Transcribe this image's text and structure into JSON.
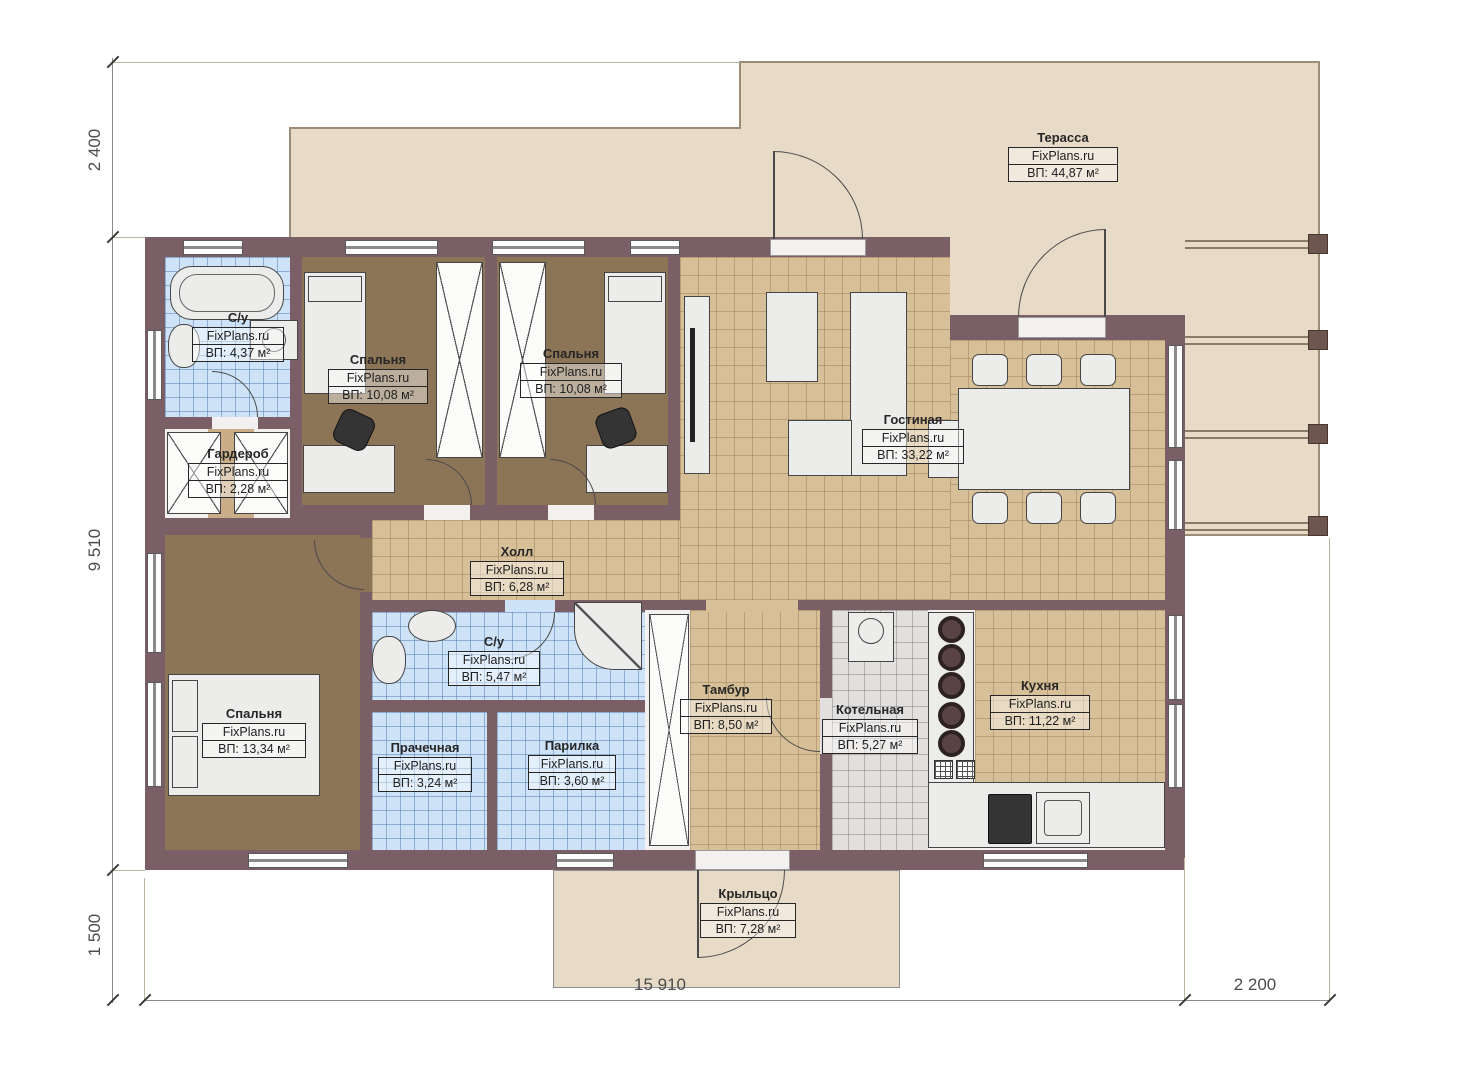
{
  "title": "План одноэтажного дома",
  "brand": "FixPlans.ru",
  "colors": {
    "wall": "#7a5f66",
    "terrace": "#e7dac6",
    "tileBlue": "#cfe3f8",
    "tileTan": "#d7bf98",
    "tileGray": "#e2e0df",
    "wood": "#8c7457"
  },
  "rooms": [
    {
      "id": "terrace",
      "name": "Терасса",
      "brand": "FixPlans.ru",
      "area": "ВП: 44,87 м²"
    },
    {
      "id": "bathroom-1",
      "name": "С/у",
      "brand": "FixPlans.ru",
      "area": "ВП: 4,37 м²"
    },
    {
      "id": "bedroom-1",
      "name": "Спальня",
      "brand": "FixPlans.ru",
      "area": "ВП: 10,08 м²"
    },
    {
      "id": "bedroom-2",
      "name": "Спальня",
      "brand": "FixPlans.ru",
      "area": "ВП: 10,08 м²"
    },
    {
      "id": "wardrobe",
      "name": "Гардероб",
      "brand": "FixPlans.ru",
      "area": "ВП: 2,28 м²"
    },
    {
      "id": "living",
      "name": "Гостиная",
      "brand": "FixPlans.ru",
      "area": "ВП: 33,22 м²"
    },
    {
      "id": "hall",
      "name": "Холл",
      "brand": "FixPlans.ru",
      "area": "ВП: 6,28 м²"
    },
    {
      "id": "bathroom-2",
      "name": "С/у",
      "brand": "FixPlans.ru",
      "area": "ВП: 5,47 м²"
    },
    {
      "id": "bedroom-3",
      "name": "Спальня",
      "brand": "FixPlans.ru",
      "area": "ВП: 13,34 м²"
    },
    {
      "id": "laundry",
      "name": "Прачечная",
      "brand": "FixPlans.ru",
      "area": "ВП: 3,24 м²"
    },
    {
      "id": "steam-room",
      "name": "Парилка",
      "brand": "FixPlans.ru",
      "area": "ВП: 3,60 м²"
    },
    {
      "id": "vestibule",
      "name": "Тамбур",
      "brand": "FixPlans.ru",
      "area": "ВП: 8,50 м²"
    },
    {
      "id": "boiler",
      "name": "Котельная",
      "brand": "FixPlans.ru",
      "area": "ВП: 5,27 м²"
    },
    {
      "id": "kitchen",
      "name": "Кухня",
      "brand": "FixPlans.ru",
      "area": "ВП: 11,22 м²"
    },
    {
      "id": "porch",
      "name": "Крыльцо",
      "brand": "FixPlans.ru",
      "area": "ВП: 7,28 м²"
    }
  ],
  "dimensions": {
    "left_top": "2 400",
    "left_middle": "9 510",
    "left_bottom": "1 500",
    "bottom_main": "15 910",
    "bottom_right": "2 200"
  }
}
